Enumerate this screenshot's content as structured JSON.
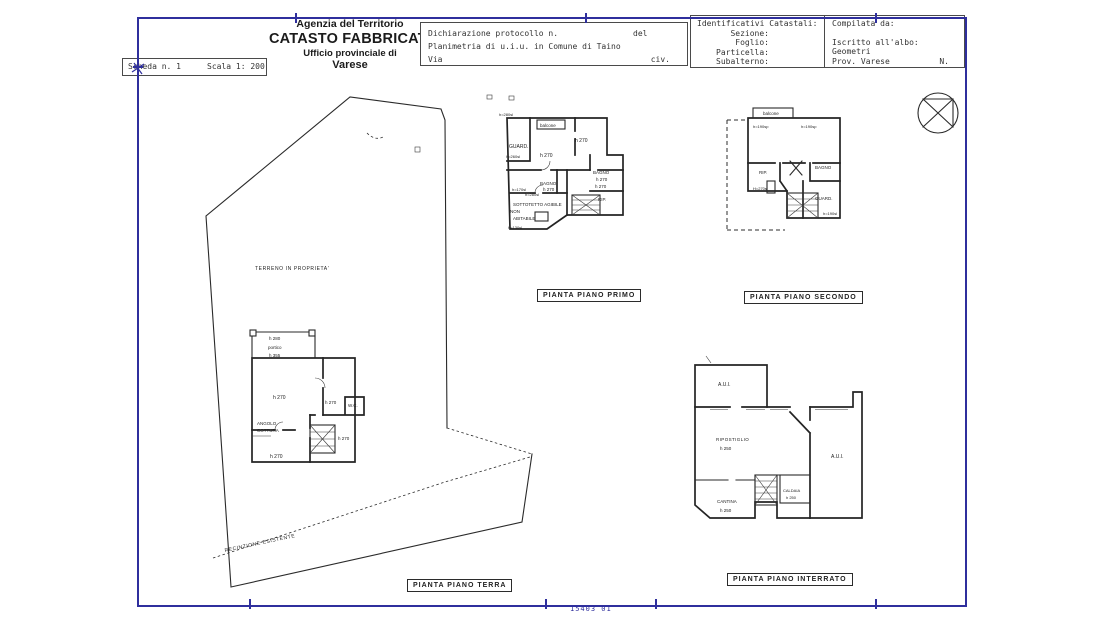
{
  "page": {
    "scheda": "Scheda n. 1",
    "scala": "Scala 1: 200",
    "footer_code": "15403 01"
  },
  "header": {
    "agency": {
      "line1": "Agenzia del Territorio",
      "line2": "CATASTO FABBRICATI",
      "line3": "Ufficio provinciale di",
      "line4": "Varese"
    },
    "declaration": {
      "protocol": "Dichiarazione protocollo n.",
      "del": "del",
      "planimetria": "Planimetria di u.i.u. in Comune di Taino",
      "via": "Via",
      "civ": "civ."
    },
    "cadastral": {
      "title": "Identificativi Catastali:",
      "sezione": "Sezione:",
      "foglio": "Foglio:",
      "particella": "Particella:",
      "subalterno": "Subalterno:"
    },
    "compiled": {
      "title": "Compilata da:",
      "albo": "Iscritto all'albo:",
      "geometri": "Geometri",
      "prov": "Prov. Varese",
      "n": "N."
    }
  },
  "plans": {
    "primo": {
      "caption": "PIANTA PIANO PRIMO",
      "labels": {
        "h280sl": "h=280sl",
        "balcone": "balcone",
        "guard": "GUARD.",
        "h260sl": "h=260sl",
        "h270_left": "h 270",
        "h270_right": "h 270",
        "bagno_left": "BAGNO",
        "bagno_left_h": "h 270",
        "bagno_right": "BAGNO",
        "bagno_right_h": "h 270",
        "h270_mid": "h 270",
        "rip": "RIP.",
        "h170sl": "h=170sl",
        "h280sl_b": "h=280sl",
        "sottotetto_1": "SOTTOTETTO AGIBILE",
        "sottotetto_2": "NON",
        "sottotetto_3": "ABITABILE",
        "h130sl": "h=130sl"
      }
    },
    "secondo": {
      "caption": "PIANTA PIANO SECONDO",
      "labels": {
        "balcone": "balcone",
        "h190sp_left": "h=190sp",
        "h190sp_right": "h=190sp",
        "rip": "RIP.",
        "bagno": "BAGNO",
        "h270sl": "H=270sl",
        "guard": "GUARD.",
        "h190sl": "h=190sl"
      }
    },
    "terra": {
      "caption": "PIANTA PIANO TERRA",
      "labels": {
        "terreno": "TERRENO IN PROPRIETA'",
        "recinzione": "RECINZIONE ESISTENTE",
        "h280": "h 280",
        "portico": "portico",
        "h355": "h 355",
        "h270_main": "h 270",
        "h270_wing": "h 270",
        "wc": "W.C.",
        "angolo_1": "ANGOLO",
        "angolo_2": "COTTURA",
        "h270_stair": "h 270",
        "h270_bottom": "h 270"
      }
    },
    "interrato": {
      "caption": "PIANTA PIANO INTERRATO",
      "labels": {
        "aui_top": "A.U.I.",
        "ripostiglio": "RIPOSTIGLIO",
        "ripostiglio_h": "h 250",
        "aui_right": "A.U.I.",
        "cantina": "CANTINA",
        "cantina_h": "h 250",
        "caldaia": "CALDAIA",
        "caldaia_h": "h 250"
      }
    }
  },
  "colors": {
    "frame": "#2f2f9d",
    "ink": "#262626"
  }
}
